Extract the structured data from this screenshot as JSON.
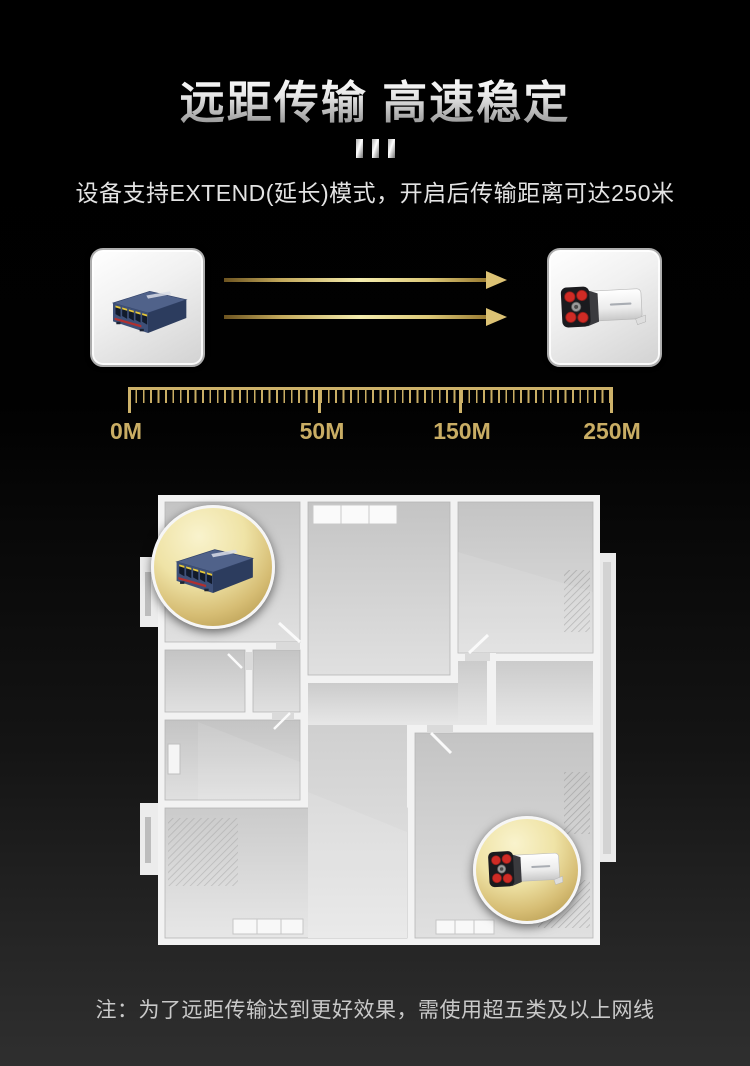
{
  "header": {
    "title": "远距传输 高速稳定",
    "subtitle": "设备支持EXTEND(延长)模式，开启后传输距离可达250米"
  },
  "diagram": {
    "icons": {
      "source": "poe-switch",
      "target": "bullet-camera",
      "link": "gold-arrow-right"
    }
  },
  "ruler": {
    "labels": [
      "0M",
      "50M",
      "150M",
      "250M"
    ]
  },
  "footer": {
    "note": "注：为了远距传输达到更好效果，需使用超五类及以上网线"
  },
  "colors": {
    "gold": "#c9ad64",
    "gold_bright": "#f4ecae",
    "gold_deep": "#8a6d2f",
    "arrow_head_gold": "#dcc274",
    "bubble_gold": "#d6bd74",
    "silver_text_top": "#ffffff",
    "silver_text_bottom": "#8d8d8d",
    "background_top": "#000000",
    "background_bottom": "#2f2f2f",
    "switch_body_blue": "#3e5078",
    "camera_led_red": "#cf2b25",
    "floor_gray": "#d6d6d6",
    "wall_white": "#f2f2f2",
    "note_gray": "#c9c9c9"
  }
}
